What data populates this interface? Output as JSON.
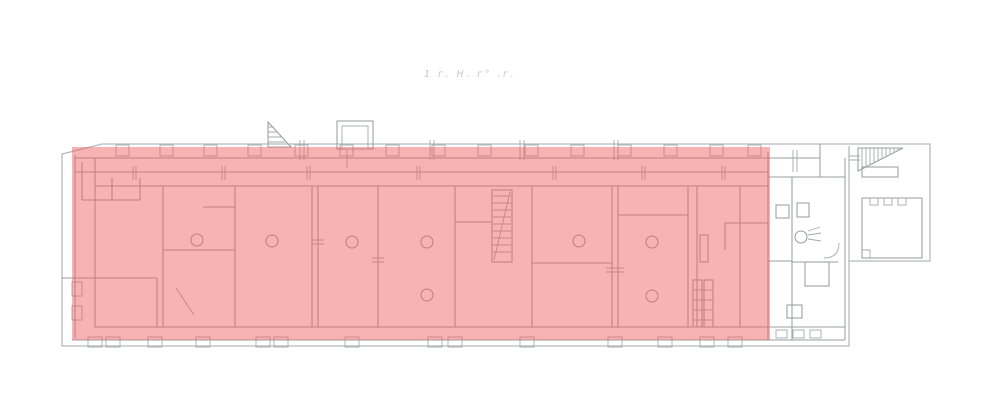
{
  "annotation": {
    "text": "1 г. Н. г° .г.",
    "color": "#c6c7ca"
  },
  "highlight": {
    "color": "#ee5f5f",
    "opacity": "0.48"
  },
  "colors": {
    "background": "#ffffff",
    "outline": "#b6b9bd",
    "wall": "#9a9da1"
  }
}
